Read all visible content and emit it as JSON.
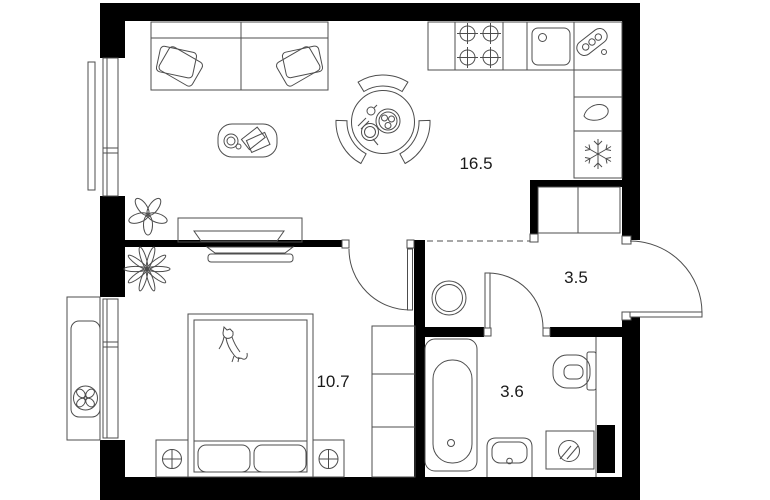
{
  "floor_plan": {
    "title": "one-bedroom apartment floor plan",
    "rooms": [
      {
        "id": "living-room-kitchen",
        "area_label": "16.5"
      },
      {
        "id": "hallway",
        "area_label": "3.5"
      },
      {
        "id": "bedroom",
        "area_label": "10.7"
      },
      {
        "id": "bathroom",
        "area_label": "3.6"
      }
    ],
    "colors": {
      "wall": "#000000",
      "line": "#4d4d4d",
      "background": "#ffffff",
      "label": "#1a1a1a"
    },
    "icons": {
      "kitchen": [
        "stove-burners-icon",
        "kitchen-sink-icon",
        "cutting-board-icon",
        "kettle-drop-icon",
        "snowflake-icon"
      ],
      "living": [
        "sofa-icon",
        "pillow-icon",
        "coffee-table-icon",
        "dining-table-icon",
        "chair-icon",
        "plant-icon",
        "tv-console-icon"
      ],
      "bedroom": [
        "bed-icon",
        "cat-icon",
        "nightstand-lamp-icon",
        "wardrobe-icon",
        "plant-icon",
        "tv-icon"
      ],
      "hallway": [
        "entry-closet-icon",
        "water-heater-icon",
        "entrance-door-icon"
      ],
      "bathroom": [
        "bathtub-icon",
        "toilet-icon",
        "washbasin-icon",
        "washing-machine-icon"
      ],
      "exterior": [
        "ac-unit-fan-icon",
        "window-icon"
      ]
    }
  }
}
